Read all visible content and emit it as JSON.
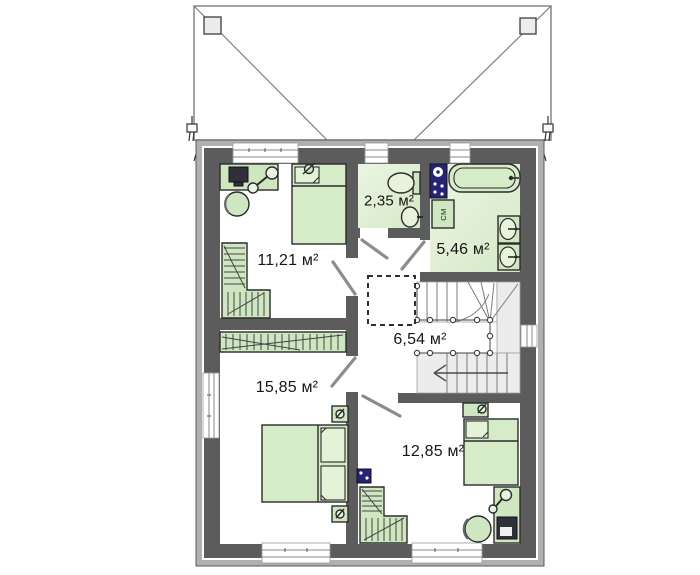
{
  "plan": {
    "rooms": [
      {
        "name": "room-top-left",
        "area": "11,21 м²"
      },
      {
        "name": "wc",
        "area": "2,35 м²"
      },
      {
        "name": "bathroom",
        "area": "5,46 м²"
      },
      {
        "name": "hall-stairs",
        "area": "6,54 м²"
      },
      {
        "name": "bedroom-bottom-left",
        "area": "15,85 м²"
      },
      {
        "name": "bedroom-bottom-right",
        "area": "12,85 м²"
      }
    ],
    "appliance_labels": {
      "washing_machine": "СМ"
    },
    "colors": {
      "wall": "#5c5c5c",
      "siding": "#b0b0b0",
      "furniture_green": "#cfe7c1",
      "floor_green": "#e4f0da",
      "tile_blue": "#232377",
      "outline": "#2b2b2b"
    }
  }
}
